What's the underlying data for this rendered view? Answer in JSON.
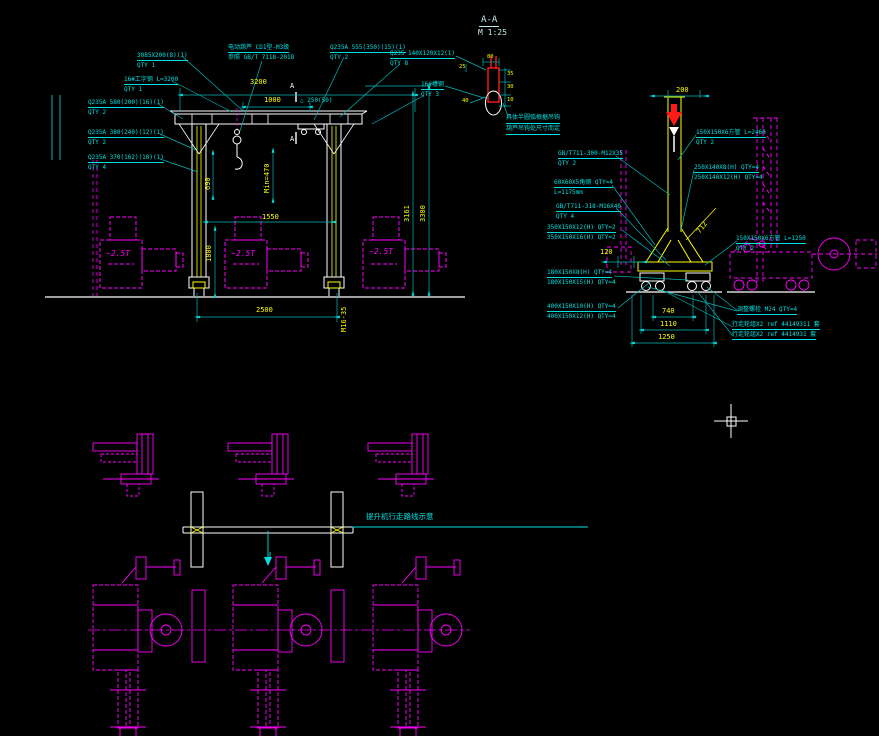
{
  "drawing": {
    "detail": {
      "title": "A-A",
      "scale": "M 1:25",
      "note1": "具体半圆弧根据吊钩",
      "note2": "葫芦吊钩处尺寸而定",
      "dims": {
        "t": "80",
        "l": "25",
        "r1": "35",
        "r2": "30",
        "r3": "10",
        "d": "40"
      }
    },
    "front": {
      "labels": [
        {
          "l1": "3085X200(8)(1)",
          "l2": "QTY 1"
        },
        {
          "l1": "16#工字钢 L=3200",
          "l2": "QTY 1"
        },
        {
          "l1": "Q235A 580(200)(16)(1)",
          "l2": "QTY 2"
        },
        {
          "l1": "Q235A 380(240)(12)(1)",
          "l2": "QTY 2"
        },
        {
          "l1": "Q235A 370(162)(10)(1)",
          "l2": "QTY 4"
        },
        {
          "l1": "电动葫芦 CD1型-M3级",
          "l2": "参照 GB/T 7118-2018"
        },
        {
          "l1": "Q235A 555(350)(15)(1)",
          "l2": "QTY 2"
        },
        {
          "l1": "Q235 140X120X12(1)",
          "l2": "QTY 8"
        },
        {
          "l1": "16#槽钢",
          "l2": "QTY 3"
        }
      ],
      "dims": {
        "beam": "3200",
        "travel": "1000",
        "plate": "△ 250(50)",
        "section": "A",
        "v690": "690",
        "min": "Min=470",
        "w1550": "1550",
        "v1800": "1800",
        "v3161": "3161",
        "v3300": "3300",
        "span": "2500",
        "bolt": "M16-35",
        "load": "~2.5T"
      }
    },
    "side": {
      "left_labels": [
        {
          "l1": "GB/T711-300-M12X35",
          "l2": "QTY 2"
        },
        {
          "l1": "60X60X5角钢 QTY=4",
          "l2": "L=1175mm"
        },
        {
          "l1": "GB/T711-318-M16X40",
          "l2": "QTY 4"
        },
        {
          "l1": "350X150X12(H) QTY=2",
          "l2": "350X150X16(H) QTY=2"
        },
        {
          "l1": "180X150X8(H) QTY=4",
          "l2": "180X150X15(H) QTY=4"
        },
        {
          "l1": "400X150X10(H) QTY=4",
          "l2": "400X150X12(H) QTY=4"
        }
      ],
      "right_labels": [
        {
          "l1": "150X150X6方管 L=2460",
          "l2": "QTY 2"
        },
        {
          "l1": "250X140X8(H) QTY=4",
          "l2": "250X140X12(H) QTY=4"
        },
        {
          "l1": "150X150X6方管 L=1250",
          "l2": "QTY 2"
        },
        {
          "l1": "调整螺栓 M24 QTY=4",
          "l2": ""
        },
        {
          "l1": "行走轮组X2 ref 44149311 套",
          "l2": "行走轮组X2 ref 4414931 套"
        }
      ],
      "dims": {
        "top": "200",
        "diag": "712",
        "offset": "120",
        "w740": "740",
        "w1110": "1110",
        "w1250": "1250"
      }
    },
    "plan": {
      "route": "提升机行走路线示意"
    }
  }
}
